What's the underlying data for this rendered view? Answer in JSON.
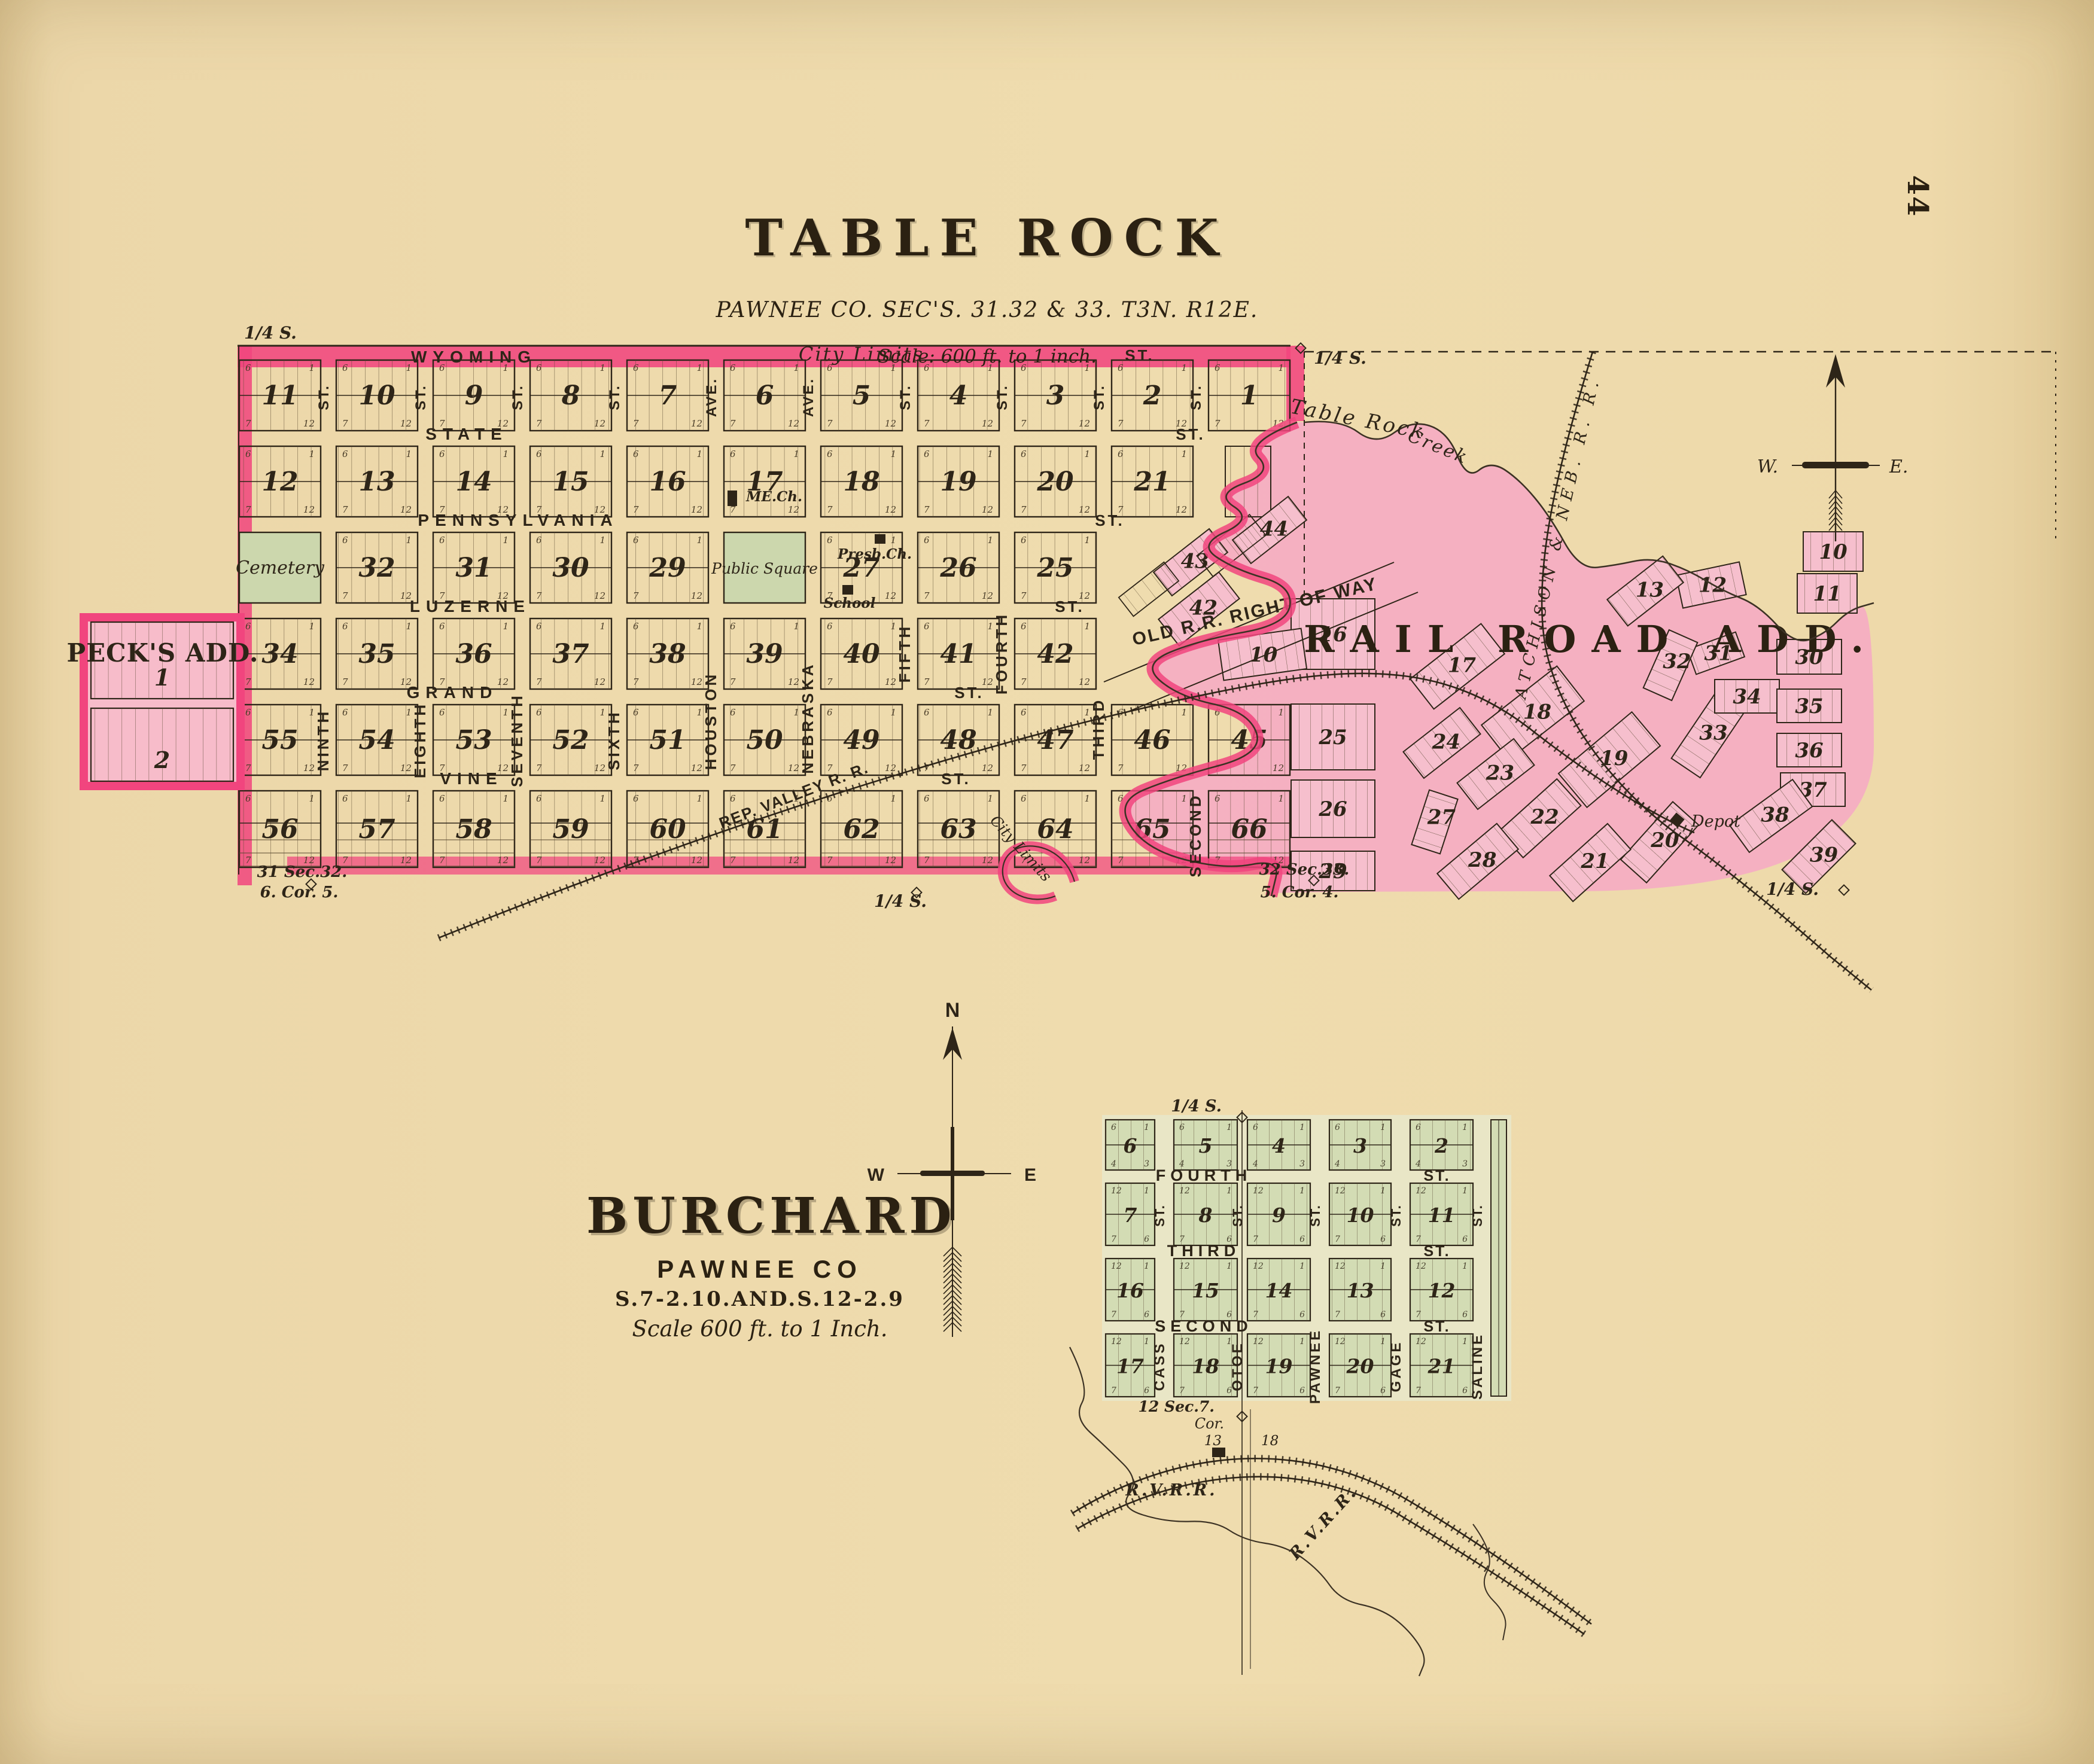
{
  "page": {
    "number": "44"
  },
  "colors": {
    "paper": "#efdcae",
    "ink": "#2e2518",
    "bright_pink": "#f1457e",
    "light_pink": "#f4aec2",
    "fan_pink": "#f6bfcd",
    "green": "#ccd7ad",
    "burchard_bg": "#e7e8ca",
    "burchard_block": "#d3dcb4",
    "creek_line": "#3c3224"
  },
  "table_rock": {
    "title": "TABLE ROCK",
    "subtitle": "PAWNEE CO. SEC'S. 31.32 & 33. T3N. R12E.",
    "scale_note": "Scale: 600 ft. to 1 inch.",
    "city_limits_top": "City Limits",
    "city_limits_creek": "City Limits",
    "h_streets": [
      {
        "name": "WYOMING",
        "suffix": "ST."
      },
      {
        "name": "STATE",
        "suffix": "ST."
      },
      {
        "name": "PENNSYLVANIA",
        "suffix": "ST."
      },
      {
        "name": "LUZERNE",
        "suffix": "ST."
      },
      {
        "name": "GRAND",
        "suffix": "ST."
      },
      {
        "name": "VINE",
        "suffix": "ST."
      }
    ],
    "v_streets": [
      {
        "name": "NINTH",
        "suffix": "ST."
      },
      {
        "name": "EIGHTH",
        "suffix": "ST."
      },
      {
        "name": "SEVENTH",
        "suffix": "ST."
      },
      {
        "name": "SIXTH",
        "suffix": "ST."
      },
      {
        "name": "HOUSTON",
        "suffix": "AVE."
      },
      {
        "name": "NEBRASKA",
        "suffix": "AVE."
      },
      {
        "name": "FIFTH",
        "suffix": "ST."
      },
      {
        "name": "FOURTH",
        "suffix": "ST."
      },
      {
        "name": "THIRD",
        "suffix": "ST."
      },
      {
        "name": "SECOND",
        "suffix": "ST."
      }
    ],
    "rows": [
      [
        {
          "c": 0,
          "n": "11"
        },
        {
          "c": 1,
          "n": "10"
        },
        {
          "c": 2,
          "n": "9"
        },
        {
          "c": 3,
          "n": "8"
        },
        {
          "c": 4,
          "n": "7"
        },
        {
          "c": 5,
          "n": "6"
        },
        {
          "c": 6,
          "n": "5"
        },
        {
          "c": 7,
          "n": "4"
        },
        {
          "c": 8,
          "n": "3"
        },
        {
          "c": 9,
          "n": "2"
        },
        {
          "c": 10,
          "n": "1"
        }
      ],
      [
        {
          "c": 0,
          "n": "12"
        },
        {
          "c": 1,
          "n": "13"
        },
        {
          "c": 2,
          "n": "14"
        },
        {
          "c": 3,
          "n": "15"
        },
        {
          "c": 4,
          "n": "16"
        },
        {
          "c": 5,
          "n": "17"
        },
        {
          "c": 6,
          "n": "18"
        },
        {
          "c": 7,
          "n": "19"
        },
        {
          "c": 8,
          "n": "20"
        },
        {
          "c": 9,
          "n": "21"
        }
      ],
      [
        {
          "c": 0,
          "g": "Cemetery"
        },
        {
          "c": 1,
          "n": "32"
        },
        {
          "c": 2,
          "n": "31"
        },
        {
          "c": 3,
          "n": "30"
        },
        {
          "c": 4,
          "n": "29"
        },
        {
          "c": 5,
          "g": "Public Square"
        },
        {
          "c": 6,
          "n": "27"
        },
        {
          "c": 7,
          "n": "26"
        },
        {
          "c": 8,
          "n": "25"
        }
      ],
      [
        {
          "c": 0,
          "n": "34"
        },
        {
          "c": 1,
          "n": "35"
        },
        {
          "c": 2,
          "n": "36"
        },
        {
          "c": 3,
          "n": "37"
        },
        {
          "c": 4,
          "n": "38"
        },
        {
          "c": 5,
          "n": "39"
        },
        {
          "c": 6,
          "n": "40"
        },
        {
          "c": 7,
          "n": "41"
        },
        {
          "c": 8,
          "n": "42"
        }
      ],
      [
        {
          "c": 0,
          "n": "55"
        },
        {
          "c": 1,
          "n": "54"
        },
        {
          "c": 2,
          "n": "53"
        },
        {
          "c": 3,
          "n": "52"
        },
        {
          "c": 4,
          "n": "51"
        },
        {
          "c": 5,
          "n": "50"
        },
        {
          "c": 6,
          "n": "49"
        },
        {
          "c": 7,
          "n": "48"
        },
        {
          "c": 8,
          "n": "47"
        },
        {
          "c": 9,
          "n": "46"
        },
        {
          "c": 10,
          "n": "45"
        }
      ],
      [
        {
          "c": 0,
          "n": "56"
        },
        {
          "c": 1,
          "n": "57"
        },
        {
          "c": 2,
          "n": "58"
        },
        {
          "c": 3,
          "n": "59"
        },
        {
          "c": 4,
          "n": "60"
        },
        {
          "c": 5,
          "n": "61"
        },
        {
          "c": 6,
          "n": "62"
        },
        {
          "c": 7,
          "n": "63"
        },
        {
          "c": 8,
          "n": "64"
        },
        {
          "c": 9,
          "n": "65"
        },
        {
          "c": 10,
          "n": "66"
        }
      ]
    ],
    "lot_corners": [
      "6",
      "1",
      "7",
      "12"
    ],
    "landmarks": {
      "me_church": "ME.Ch.",
      "presb_church": "Presb.Ch.",
      "school": "School",
      "depot": "Depot"
    },
    "creek": {
      "label_a": "Table Rock",
      "label_b": "Creek"
    },
    "corners": {
      "tl": "1/4 S.",
      "tr": "1/4 S.",
      "bl_1": "31 Sec.32.",
      "bl_2": "6. Cor. 5.",
      "bm": "1/4 S.",
      "bm2_1": "32  Sec.33.",
      "bm2_2": "5. Cor. 4.",
      "br": "1/4 S."
    },
    "compass": {
      "w": "W.",
      "e": "E."
    }
  },
  "railroads": {
    "atchison": "ATCHISON & NEB. R. R.",
    "rep_valley": "REP. VALLEY  R. R.",
    "old_row": "OLD R.R. RIGHT OF WAY",
    "rvrr_1": "R.V.R.R.",
    "rvrr_2": "R.V.R.R."
  },
  "pecks": {
    "title": "PECK'S ADD.",
    "blocks": [
      "1",
      "2"
    ]
  },
  "rr_add": {
    "title": "RAIL ROAD ADD.",
    "blocks": [
      "16",
      "25",
      "26",
      "29",
      "17",
      "18",
      "19",
      "20",
      "21",
      "22",
      "23",
      "24",
      "27",
      "28",
      "30",
      "31",
      "32",
      "33",
      "34",
      "35",
      "36",
      "37",
      "38",
      "39",
      "10",
      "11",
      "12",
      "13",
      "44",
      "43",
      "42",
      "10"
    ]
  },
  "burchard": {
    "title": "BURCHARD",
    "subtitle": "PAWNEE CO",
    "sections_note": "S.7-2.10.AND.S.12-2.9",
    "scale_note": "Scale 600 ft. to 1 Inch.",
    "quarter": "1/4 S.",
    "sec_corner": {
      "a": "12 Sec.7.",
      "b": "Cor.",
      "c": "13",
      "d": "18"
    },
    "h_streets": [
      {
        "name": "FOURTH",
        "suffix": "ST."
      },
      {
        "name": "THIRD",
        "suffix": "ST."
      },
      {
        "name": "SECOND",
        "suffix": "ST."
      }
    ],
    "v_streets": [
      {
        "name": "CASS",
        "suffix": "ST."
      },
      {
        "name": "OTOE",
        "suffix": "ST."
      },
      {
        "name": "PAWNEE",
        "suffix": "ST."
      },
      {
        "name": "GAGE",
        "suffix": "ST."
      },
      {
        "name": "SALINE",
        "suffix": "ST."
      }
    ],
    "rows": [
      [
        "6",
        "5",
        "4",
        "3",
        "2"
      ],
      [
        "7",
        "8",
        "9",
        "10",
        "11"
      ],
      [
        "16",
        "15",
        "14",
        "13",
        "12"
      ],
      [
        "17",
        "18",
        "19",
        "20",
        "21"
      ]
    ],
    "lot_corners_row0": [
      "6",
      "1",
      "4",
      "3"
    ],
    "lot_corners": [
      "12",
      "1",
      "7",
      "6"
    ],
    "compass": {
      "n": "N",
      "w": "W",
      "e": "E"
    }
  }
}
